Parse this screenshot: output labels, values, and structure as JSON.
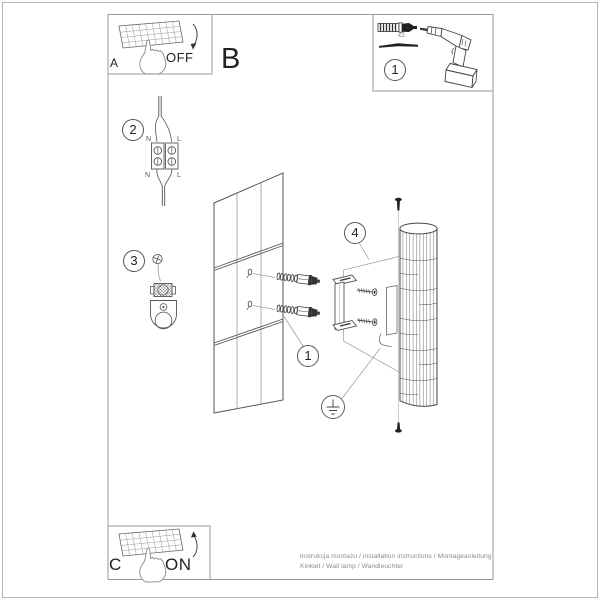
{
  "labels": {
    "panel_a": "A",
    "panel_b": "B",
    "panel_c": "C",
    "switch_off": "OFF",
    "switch_on": "ON",
    "qty_anchors": "x2"
  },
  "callouts": {
    "tools_box": "1",
    "anchors": "1",
    "wiring": "2",
    "bracket": "3",
    "lamp": "4"
  },
  "wiring_labels": {
    "in_n": "N",
    "in_l": "L",
    "out_n": "N",
    "out_l": "L"
  },
  "footer": {
    "line1": "Instrukcja montażu / installation instructions / Montageanleitung",
    "line2": "Kinkiet / Wall lamp / Wandleuchter"
  },
  "icons": {
    "tools": [
      "wall-plug-icon",
      "drill-bit-icon",
      "cordless-drill-icon"
    ],
    "power": [
      "switch-panel-icon",
      "pointing-hand-icon",
      "arrow-down-icon",
      "arrow-up-icon"
    ],
    "assembly": [
      "wall-tiles",
      "wall-anchor-icon",
      "mounting-rail-icon",
      "fixing-screw-icon",
      "lamp-cylinder",
      "earth-symbol-icon",
      "terminal-block-icon",
      "cable-clamp-icon"
    ]
  },
  "colors": {
    "paper": "#ffffff",
    "frame": "#9a9a9a",
    "line_art": "#444444",
    "muted_text": "#8a8a8a",
    "text": "#222222"
  }
}
